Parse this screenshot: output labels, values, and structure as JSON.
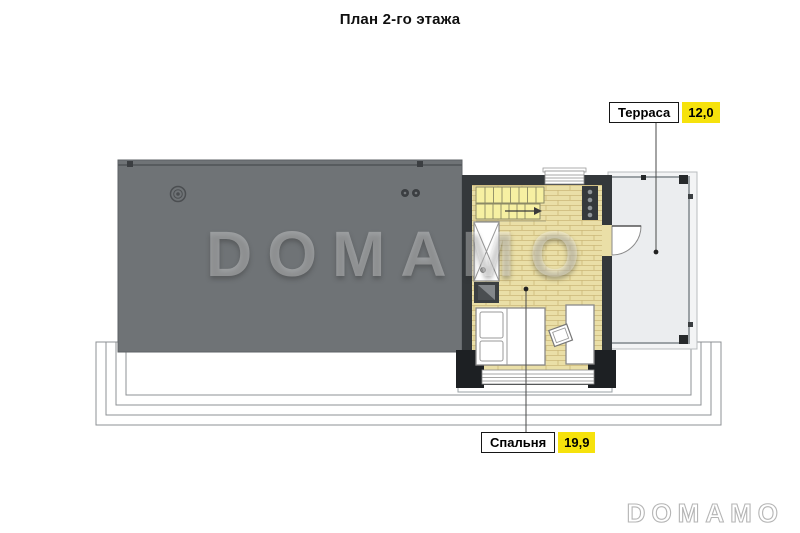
{
  "page": {
    "title": "План 2-го этажа"
  },
  "watermark": {
    "text": "DOMAMO"
  },
  "logo": {
    "text": "DOMAMO"
  },
  "rooms": [
    {
      "name": "Терраса",
      "area": "12,0"
    },
    {
      "name": "Спальня",
      "area": "19,9"
    }
  ],
  "colors": {
    "roof_gray": "#6f7376",
    "wall_dark": "#34383b",
    "corner_post_black": "#1d2023",
    "floor_parquet_yellow": "#eadfa7",
    "stairs_yellow": "#f6f0a2",
    "terrace_deck_gray": "#ebedef",
    "label_area_yellow": "#f6e20c",
    "step_outline_gray": "#8e9194"
  }
}
